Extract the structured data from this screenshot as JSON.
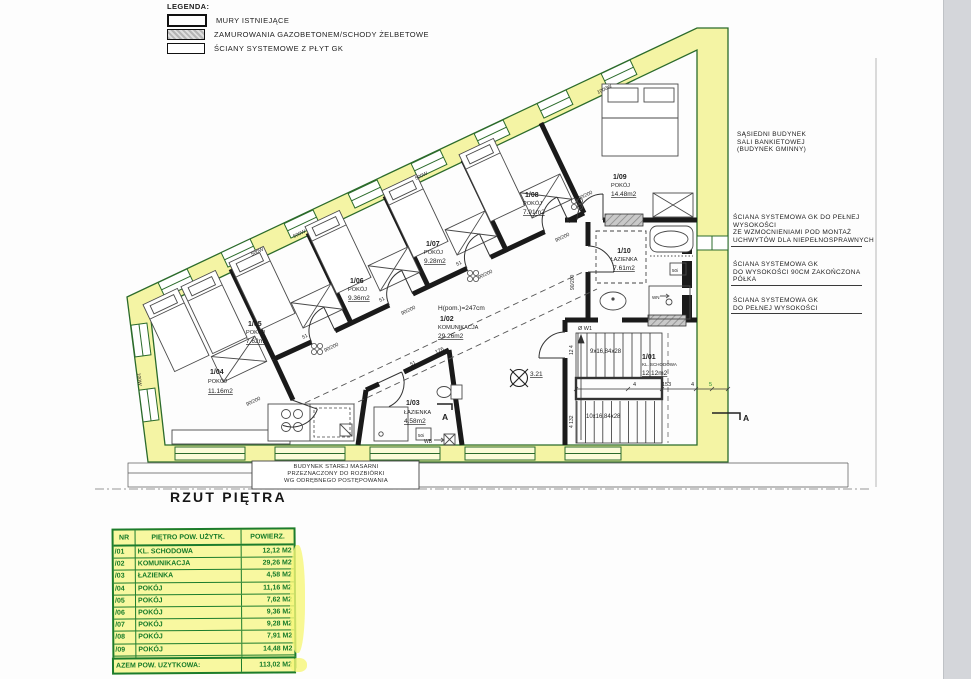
{
  "page": {
    "title": "RZUT PIĘTRA"
  },
  "legend": {
    "title": "LEGENDA:",
    "items": [
      {
        "label": "MURY ISTNIEJĄCE",
        "swatch": "existing-walls"
      },
      {
        "label": "ZAMUROWANIA GAZOBETONEM/SCHODY ŻELBETOWE",
        "swatch": "infill-hatch"
      },
      {
        "label": "ŚCIANY SYSTEMOWE Z PŁYT GK",
        "swatch": "gk-partition"
      }
    ]
  },
  "side_notes": {
    "neighbor": "SĄSIEDNI BUDYNEK\nSALI BANKIETOWEJ\n(BUDYNEK GMINNY)",
    "wall_note_1": "ŚCIANA SYSTEMOWA GK DO PEŁNEJ\nWYSOKOŚCI\nZE WZMOCNIENIAMI POD MONTAŻ\nUCHWYTÓW DLA NIEPEŁNOSPRAWNYCH",
    "wall_note_2": "ŚCIANA SYSTEMOWA GK\nDO WYSOKOŚCI 90CM ZAKOŃCZONA\nPÓŁKA",
    "wall_note_3": "ŚCIANA SYSTEMOWA GK\nDO PEŁNEJ WYSOKOŚCI"
  },
  "demolition_note": "BUDYNEK STAREJ MASARNI\nPRZEZNACZONY DO ROZBIÓRKI\nWG ODRĘBNEGO POSTĘPOWANIA",
  "rooms": {
    "r01": {
      "id": "1/01",
      "name": "KL. SCHODOWA",
      "area": "12.12m2"
    },
    "r02": {
      "id": "1/02",
      "name": "KOMUNIKACJA",
      "area": "29.26m2"
    },
    "r03": {
      "id": "1/03",
      "name": "ŁAZIENKA",
      "area": "4.58m2"
    },
    "r04": {
      "id": "1/04",
      "name": "POKÓJ",
      "area": "11.16m2"
    },
    "r05": {
      "id": "1/05",
      "name": "POKÓJ",
      "area": "7.62m2"
    },
    "r06": {
      "id": "1/06",
      "name": "POKÓJ",
      "area": "9.36m2"
    },
    "r07": {
      "id": "1/07",
      "name": "POKÓJ",
      "area": "9.28m2"
    },
    "r08": {
      "id": "1/08",
      "name": "POKÓJ",
      "area": "7.91m2"
    },
    "r09": {
      "id": "1/09",
      "name": "POKÓJ",
      "area": "14.48m2"
    },
    "r10": {
      "id": "1/10",
      "name": "ŁAZIENKA",
      "area": "7.61m2"
    }
  },
  "plan_labels": {
    "ceiling_height": "H(pom.)=247cm",
    "level_mark": "3.21",
    "stairs_up": "9x16,84x28",
    "stairs_down": "10x16,84x28",
    "door_size": "90/200",
    "window_500": "500W",
    "window_1000": "1000W",
    "window_100": "100W",
    "dim_153": "153",
    "dim_4": "4",
    "dim_5": "5",
    "dim_51": "51",
    "dim_126": "126",
    "dim_12_4": "12 4",
    "dim_4_132": "4 132",
    "vent_w1": "Ø W1",
    "wb": "WB",
    "wn": "WN",
    "box_50i": "50i",
    "section_mark": "A"
  },
  "table": {
    "headers": {
      "nr": "NR",
      "name": "PIĘTRO POW. UŻYTK.",
      "area": "POWIERZ."
    },
    "rows": [
      {
        "nr": "/01",
        "name": "KL. SCHODOWA",
        "area": "12,12 M2"
      },
      {
        "nr": "/02",
        "name": "KOMUNIKACJA",
        "area": "29,26 M2"
      },
      {
        "nr": "/03",
        "name": "ŁAZIENKA",
        "area": "4,58 M2"
      },
      {
        "nr": "/04",
        "name": "POKÓJ",
        "area": "11,16 M2"
      },
      {
        "nr": "/05",
        "name": "POKÓJ",
        "area": "7,62 M2"
      },
      {
        "nr": "/06",
        "name": "POKÓJ",
        "area": "9,36 M2"
      },
      {
        "nr": "/07",
        "name": "POKÓJ",
        "area": "9,28 M2"
      },
      {
        "nr": "/08",
        "name": "POKÓJ",
        "area": "7,91 M2"
      },
      {
        "nr": "/09",
        "name": "POKÓJ",
        "area": "14,48 M2"
      },
      {
        "nr": "/10",
        "name": "ŁAZIENKA",
        "area": "7,61 M2"
      }
    ],
    "footer": {
      "label": "AZEM POW. UŻYTKOWA:",
      "value": "113,02 M2"
    }
  },
  "colors": {
    "wall_yellow": "#f4f4a4",
    "wall_green": "#2b6b2b",
    "table_green": "#1c7c2c",
    "table_yellow": "#f8f8a0"
  }
}
